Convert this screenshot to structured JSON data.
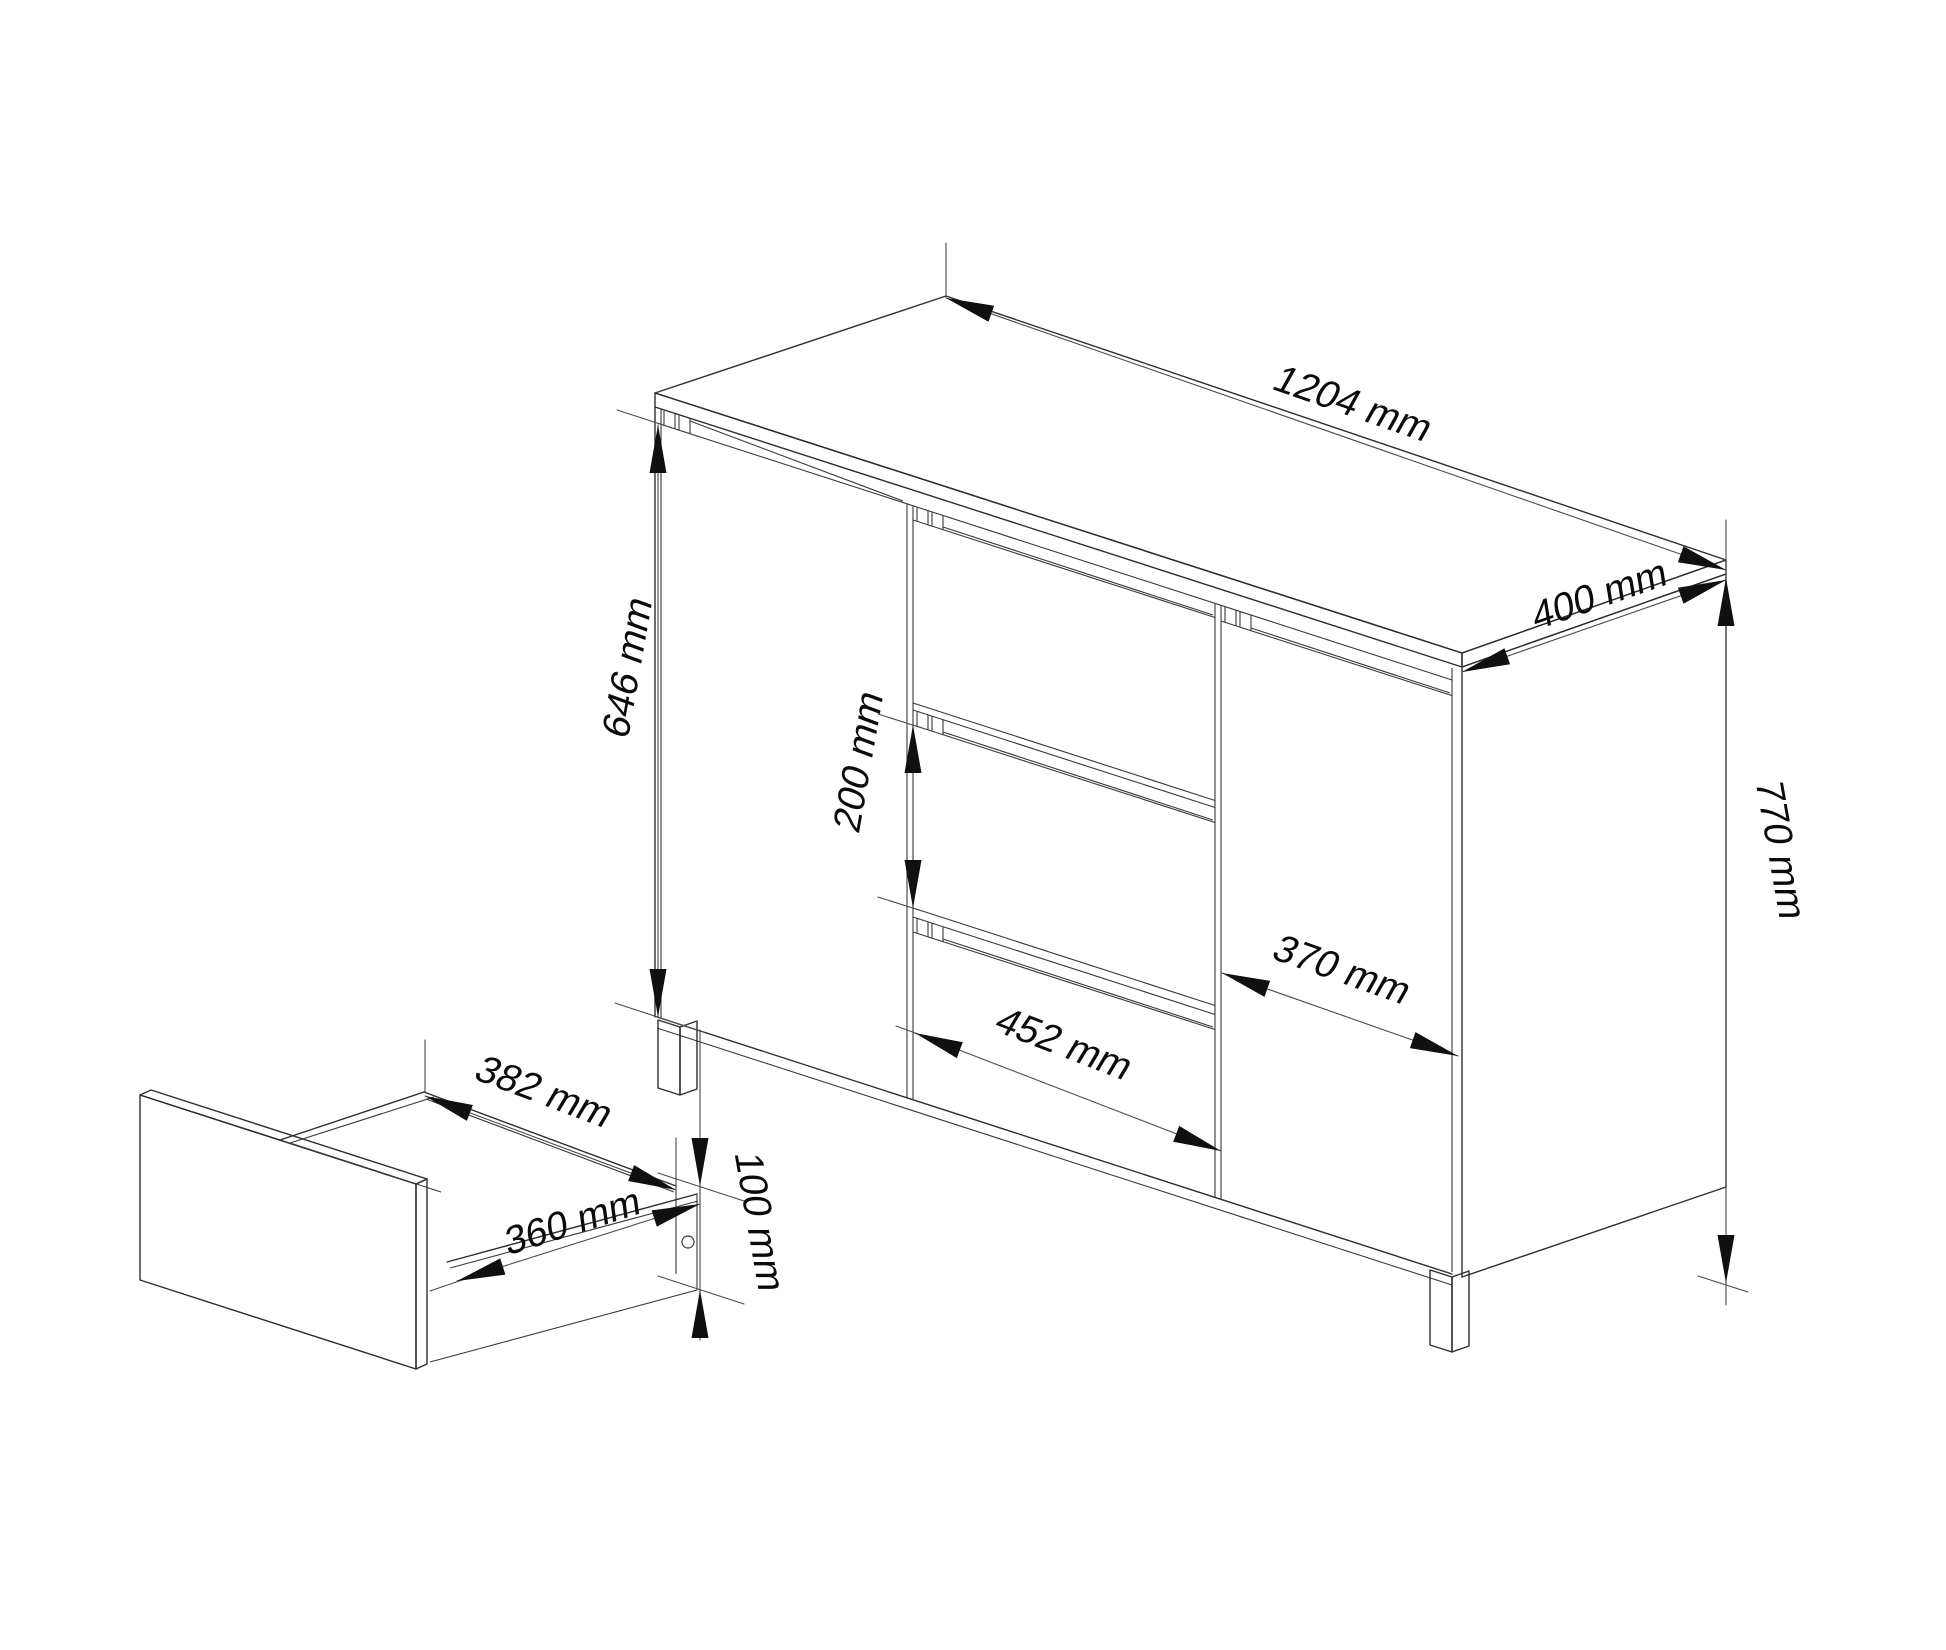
{
  "figure": {
    "kind": "isometric furniture dimension drawing",
    "subject": "sideboard with two doors, three central drawers and one detached drawer box",
    "background_color": "#ffffff",
    "line_color": "#2e2e2e",
    "dimension_line_color": "#4a4a4a",
    "text_color": "#0b0b0b"
  },
  "dimensions": {
    "cabinet_width": {
      "label": "1204 mm",
      "value_mm": 1204
    },
    "cabinet_depth": {
      "label": "400 mm",
      "value_mm": 400
    },
    "door_front_height": {
      "label": "646 mm",
      "value_mm": 646
    },
    "drawer_front_height": {
      "label": "200 mm",
      "value_mm": 200
    },
    "drawer_column_width": {
      "label": "452 mm",
      "value_mm": 452
    },
    "right_door_width": {
      "label": "370 mm",
      "value_mm": 370
    },
    "drawer_inner_width": {
      "label": "382 mm",
      "value_mm": 382
    },
    "drawer_inner_depth": {
      "label": "360 mm",
      "value_mm": 360
    },
    "drawer_side_height": {
      "label": "100 mm",
      "value_mm": 100
    },
    "cabinet_total_height": {
      "label": "770 mm",
      "value_mm": 770
    }
  }
}
